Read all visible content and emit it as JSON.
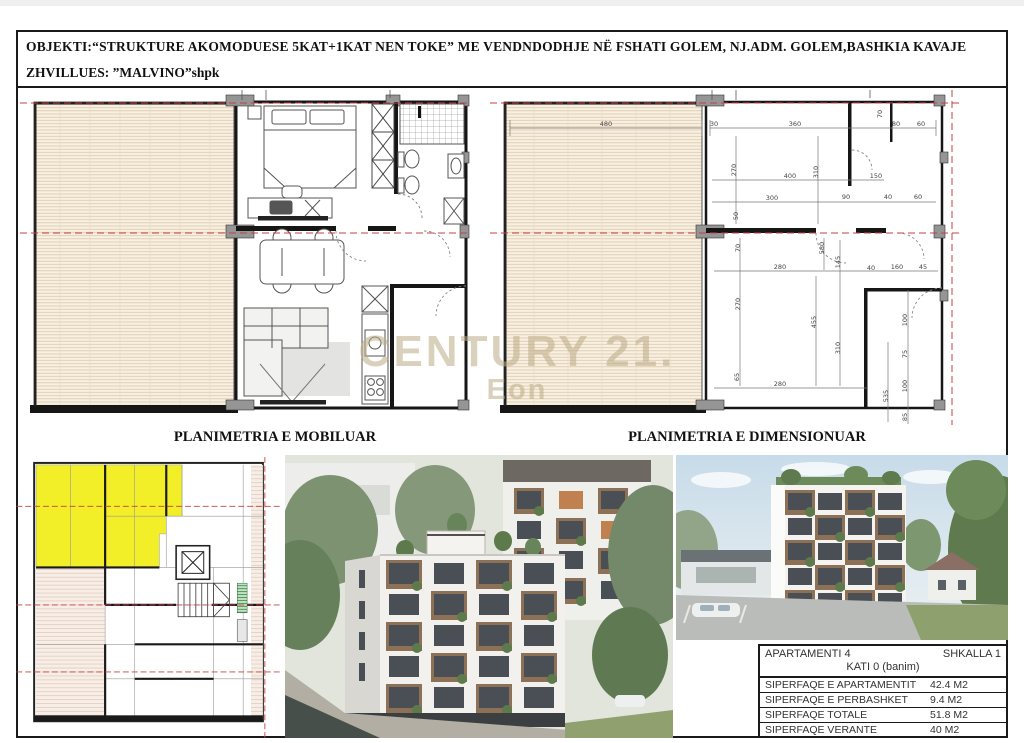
{
  "header": {
    "line1": "OBJEKTI:“STRUKTURE AKOMODUESE 5KAT+1KAT NEN TOKE” ME VENDNDODHJE NË FSHATI GOLEM, NJ.ADM. GOLEM,BASHKIA KAVAJE",
    "line2": "ZHVILLUES: ”MALVINO”shpk"
  },
  "plans": {
    "furnished": {
      "caption": "PLANIMETRIA E MOBILUAR"
    },
    "dimensioned": {
      "caption": "PLANIMETRIA E DIMENSIONUAR",
      "dims": [
        {
          "v": "480",
          "x": 116,
          "y": 36,
          "r": 0
        },
        {
          "v": "30",
          "x": 224,
          "y": 36,
          "r": 0
        },
        {
          "v": "360",
          "x": 305,
          "y": 36,
          "r": 0
        },
        {
          "v": "70",
          "x": 392,
          "y": 24,
          "r": 90
        },
        {
          "v": "80",
          "x": 406,
          "y": 36,
          "r": 0
        },
        {
          "v": "60",
          "x": 431,
          "y": 36,
          "r": 0
        },
        {
          "v": "270",
          "x": 246,
          "y": 80,
          "r": 90
        },
        {
          "v": "310",
          "x": 328,
          "y": 82,
          "r": 90
        },
        {
          "v": "400",
          "x": 300,
          "y": 88,
          "r": 0
        },
        {
          "v": "150",
          "x": 386,
          "y": 88,
          "r": 0
        },
        {
          "v": "300",
          "x": 282,
          "y": 110,
          "r": 0
        },
        {
          "v": "90",
          "x": 356,
          "y": 109,
          "r": 0
        },
        {
          "v": "40",
          "x": 398,
          "y": 109,
          "r": 0
        },
        {
          "v": "60",
          "x": 428,
          "y": 109,
          "r": 0
        },
        {
          "v": "50",
          "x": 248,
          "y": 126,
          "r": 90
        },
        {
          "v": "70",
          "x": 250,
          "y": 158,
          "r": 90
        },
        {
          "v": "580",
          "x": 334,
          "y": 158,
          "r": 90
        },
        {
          "v": "145",
          "x": 350,
          "y": 172,
          "r": 90
        },
        {
          "v": "280",
          "x": 290,
          "y": 179,
          "r": 0
        },
        {
          "v": "40",
          "x": 381,
          "y": 180,
          "r": 0
        },
        {
          "v": "160",
          "x": 407,
          "y": 179,
          "r": 0
        },
        {
          "v": "45",
          "x": 433,
          "y": 179,
          "r": 0
        },
        {
          "v": "270",
          "x": 250,
          "y": 214,
          "r": 90
        },
        {
          "v": "455",
          "x": 326,
          "y": 232,
          "r": 90
        },
        {
          "v": "310",
          "x": 350,
          "y": 258,
          "r": 90
        },
        {
          "v": "65",
          "x": 249,
          "y": 287,
          "r": 90
        },
        {
          "v": "280",
          "x": 290,
          "y": 296,
          "r": 0
        },
        {
          "v": "535",
          "x": 398,
          "y": 306,
          "r": 90
        },
        {
          "v": "100",
          "x": 417,
          "y": 230,
          "r": 90
        },
        {
          "v": "75",
          "x": 417,
          "y": 264,
          "r": 90
        },
        {
          "v": "100",
          "x": 417,
          "y": 296,
          "r": 90
        },
        {
          "v": "85",
          "x": 417,
          "y": 327,
          "r": 90
        }
      ]
    }
  },
  "watermark": {
    "line1": "CENTURY 21.",
    "line2": "Eon"
  },
  "info_table": {
    "apartment_label": "APARTAMENTI 4",
    "stair_label": "SHKALLA 1",
    "floor_label": "KATI 0 (banim)",
    "rows": [
      {
        "label": "SIPERFAQE E APARTAMENTIT",
        "value": "42.4 M2"
      },
      {
        "label": "SIPERFAQE E PERBASHKET",
        "value": "9.4 M2"
      },
      {
        "label": "SIPERFAQE TOTALE",
        "value": "51.8 M2"
      },
      {
        "label": "SIPERFAQE VERANTE",
        "value": "40 M2"
      }
    ]
  },
  "colors": {
    "highlight_yellow": "#f2ee28",
    "terrace_cream": "#f8f0e1",
    "hatch_line": "#dcc7ab",
    "axis_red": "#c64040",
    "wall_dark": "#161616",
    "pillar_gray": "#959595",
    "balcony_wood": "#8c7157",
    "plant_green": "#5d7a4c"
  }
}
